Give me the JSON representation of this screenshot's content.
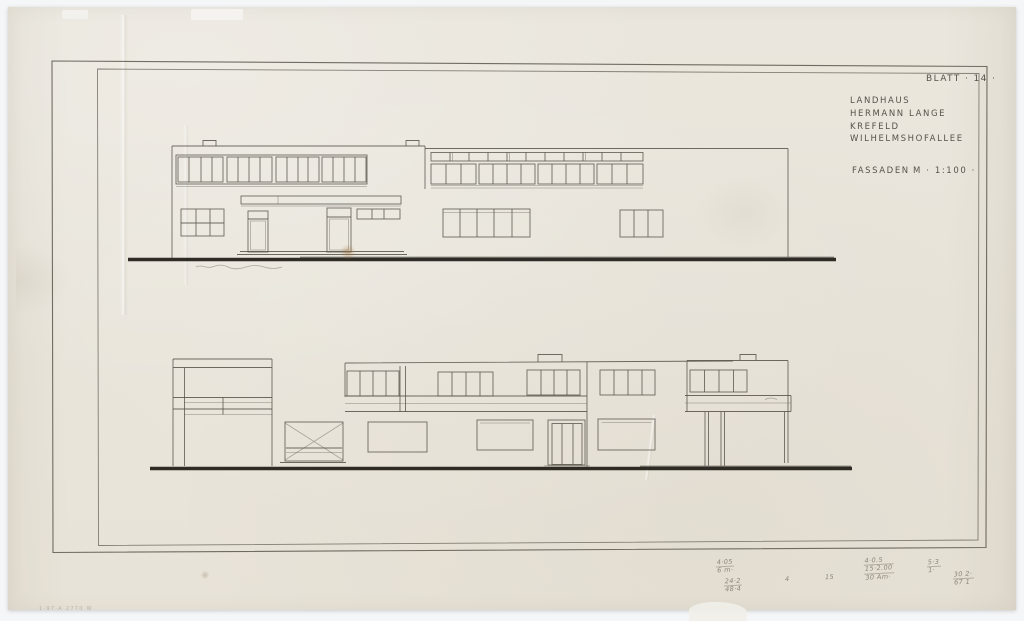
{
  "colors": {
    "background": "#f5f6f8",
    "paper": "#e9e5db",
    "ink": "#3c3831",
    "pencil_line": "#57524a",
    "ground_line": "#1e1b16"
  },
  "title_block": {
    "sheet_label": "BLATT · 14 ·",
    "line1": "LANDHAUS",
    "line2": "HERMANN LANGE",
    "line3": "KREFELD",
    "line4": "WILHELMSHOFALLEE",
    "drawing_label": "FASSADEN",
    "scale_label": "M · 1:100 ·"
  },
  "pencil_notes": {
    "note1_top": "4·05",
    "note1_bottom": "6 m·",
    "note2_top": "24·2",
    "note2_bottom": "48·4",
    "note3": "4",
    "note4": "15",
    "note5_line1": "4·0.5",
    "note5_line2": "15·2.00",
    "note5_line3": "30 Am·",
    "note6_top": "5·3",
    "note6_bottom": "1·",
    "note7_top": "30 2·",
    "note7_bottom": "67 1"
  },
  "corner_mark": "1·97·A 2770 W"
}
